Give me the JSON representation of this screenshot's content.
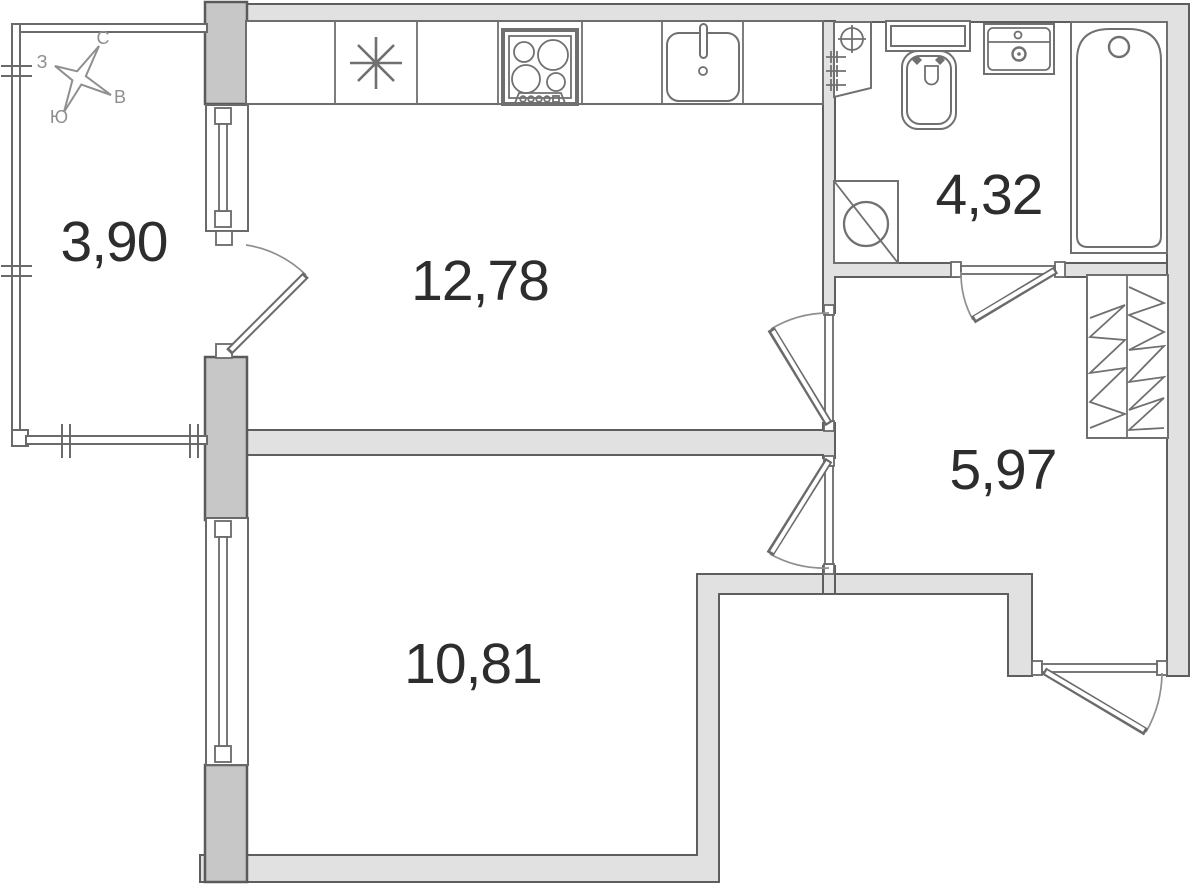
{
  "floor_plan": {
    "compass": {
      "north": "С",
      "west": "З",
      "east": "В",
      "south": "Ю"
    },
    "rooms": {
      "balcony": {
        "area": "3,90"
      },
      "kitchen": {
        "area": "12,78"
      },
      "bathroom": {
        "area": "4,32"
      },
      "hallway": {
        "area": "5,97"
      },
      "living_room": {
        "area": "10,81"
      }
    },
    "symbols": [
      "compass-rose-icon",
      "refrigerator-icon",
      "stove-icon",
      "kitchen-sink-icon",
      "plumbing-riser-icon",
      "toilet-icon",
      "washbasin-icon",
      "bathtub-icon",
      "washing-machine-icon",
      "wardrobe-icon",
      "door-swing-icon",
      "window-icon"
    ],
    "colors": {
      "background": "#ffffff",
      "wall_fill": "#e1e1e1",
      "wall_dark_fill": "#c7c7c7",
      "wall_stroke": "#5e5e5e",
      "fixture_stroke": "#707070",
      "label_text": "#2d2d2d",
      "compass_text": "#8f8f8f"
    }
  }
}
